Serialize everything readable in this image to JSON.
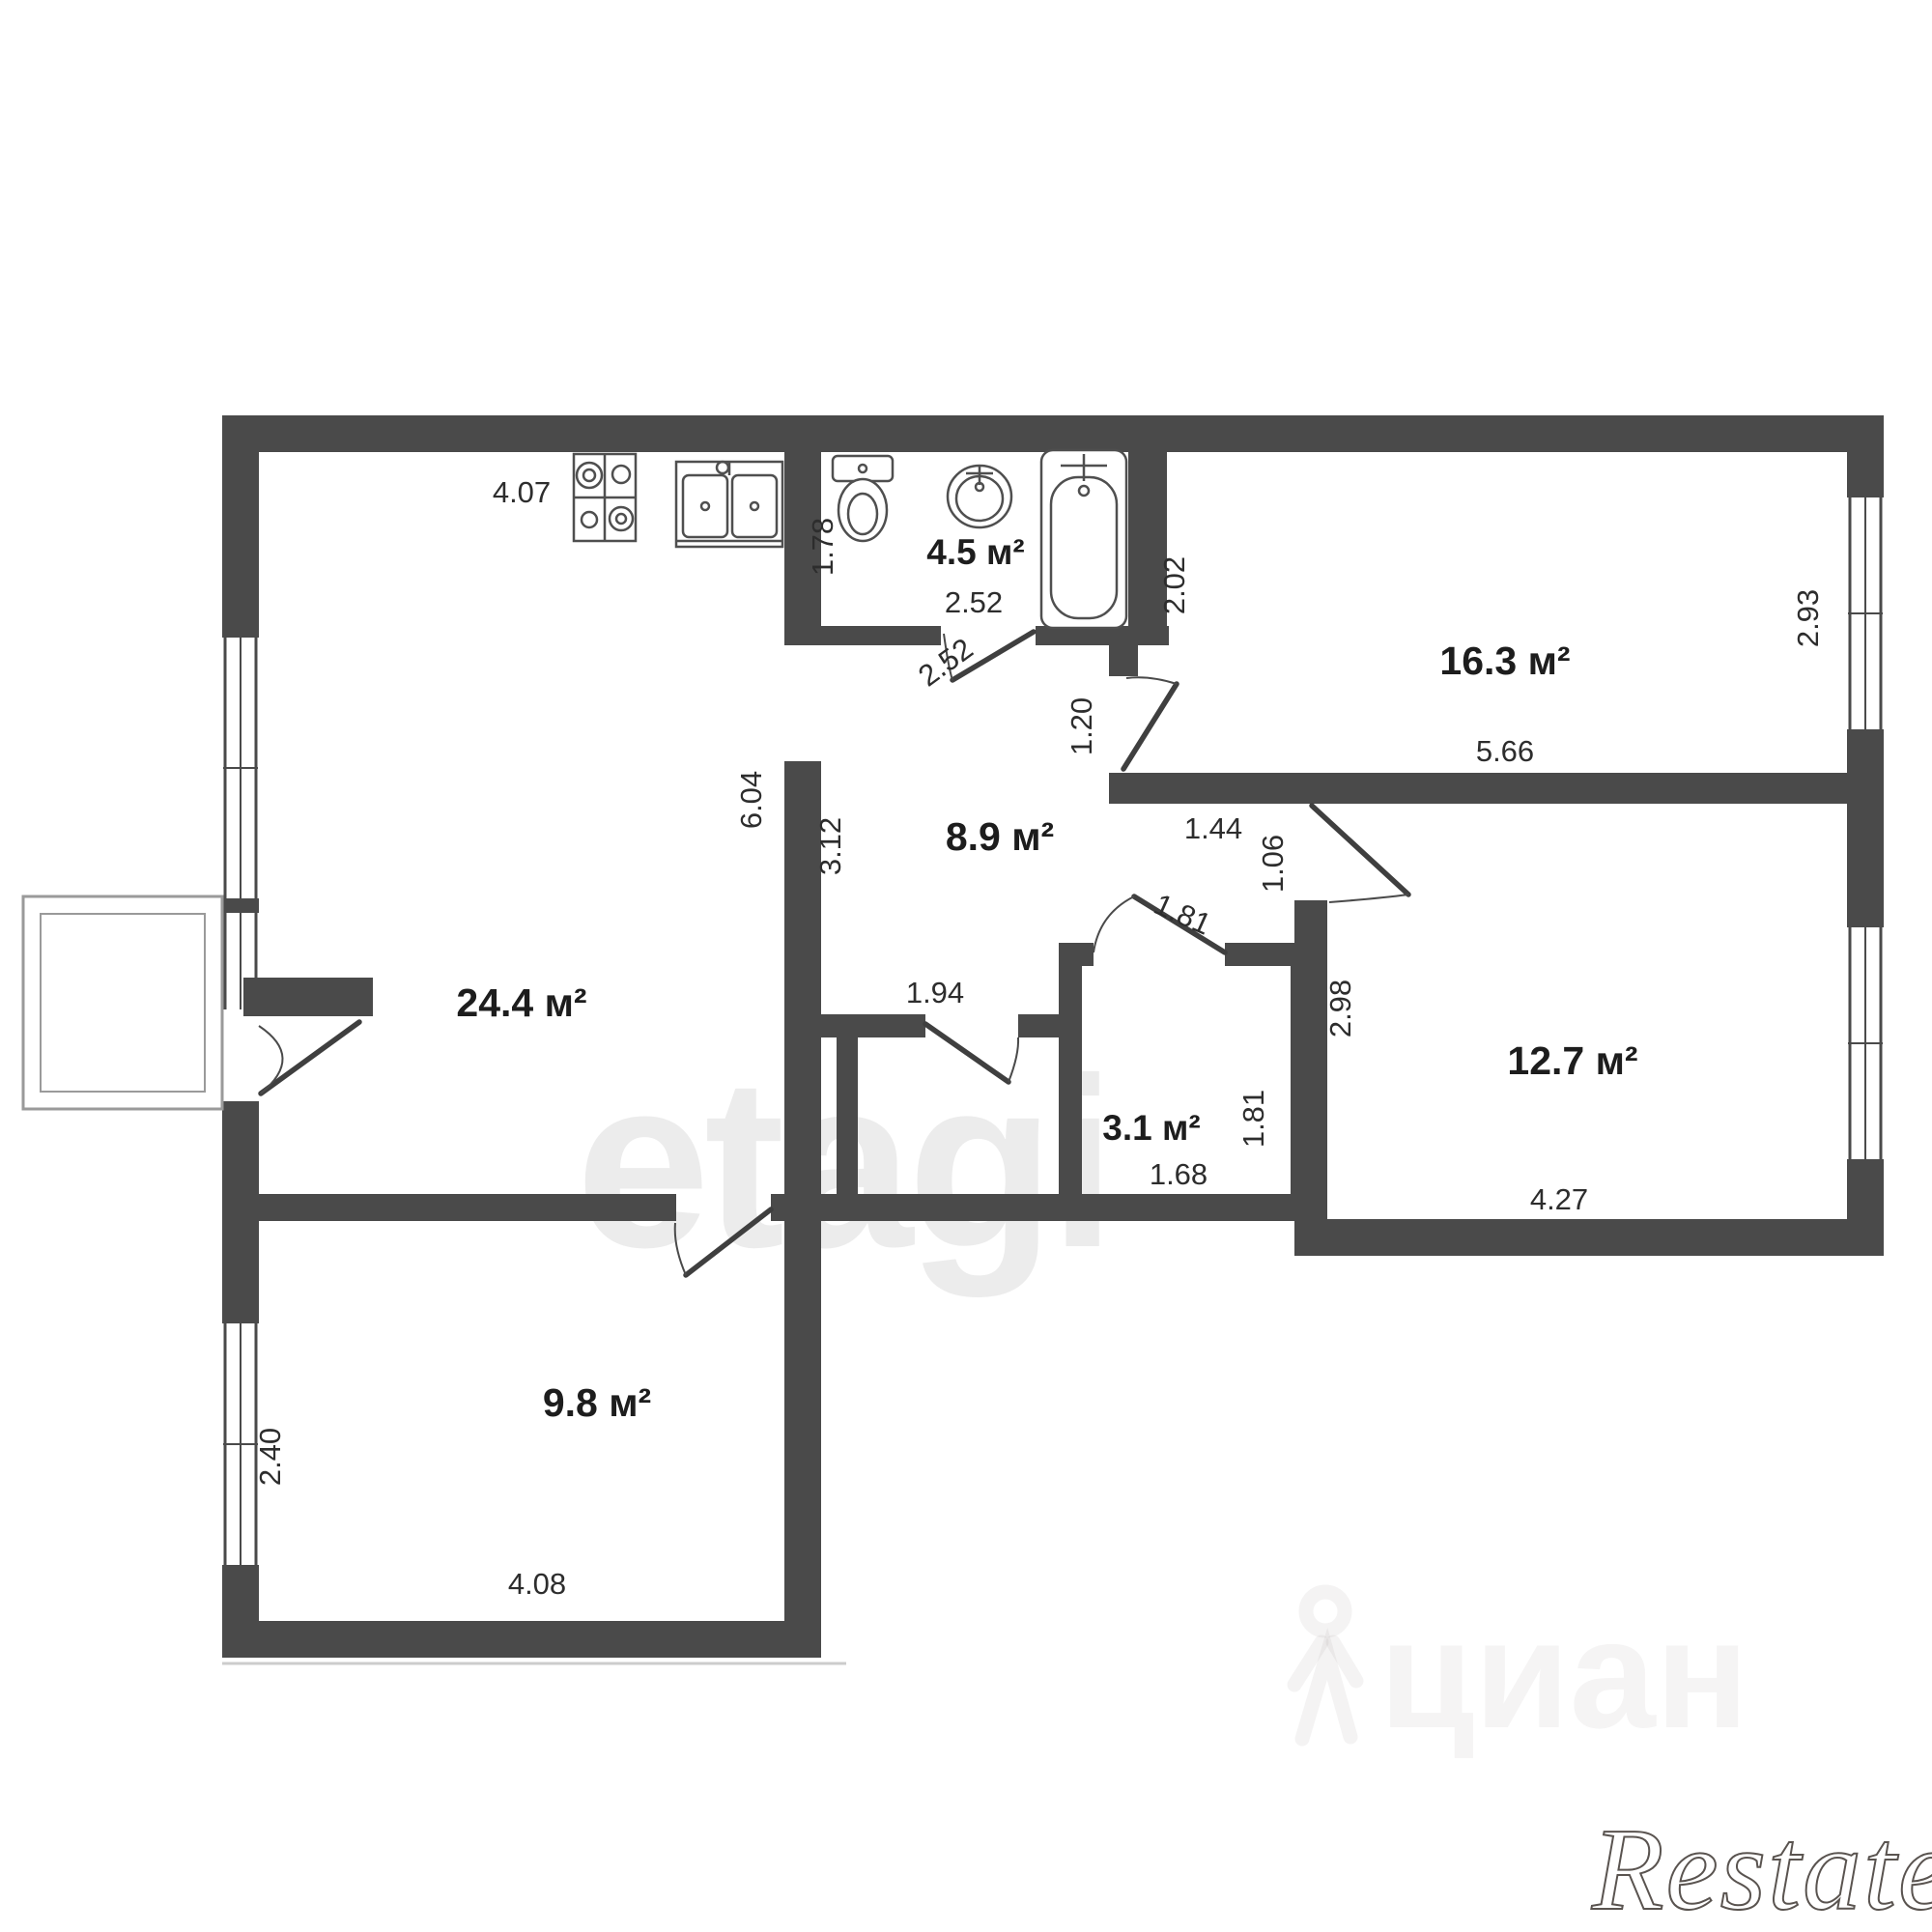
{
  "page": {
    "background": "#ffffff"
  },
  "plan": {
    "type": "apartment-floor-plan",
    "wall_color": "#4a4a4a",
    "rooms": [
      {
        "id": "living-kitchen",
        "label": "24.4 м²"
      },
      {
        "id": "bathroom",
        "label": "4.5 м²"
      },
      {
        "id": "bedroom-large",
        "label": "16.3 м²"
      },
      {
        "id": "hallway",
        "label": "8.9 м²"
      },
      {
        "id": "storage",
        "label": "3.1 м²"
      },
      {
        "id": "bedroom-medium",
        "label": "12.7 м²"
      },
      {
        "id": "bedroom-small",
        "label": "9.8 м²"
      }
    ],
    "dimensions": {
      "kitchen_top": "4.07",
      "bath_height": "1.78",
      "bath_width": "2.52",
      "bath_door": "2.52",
      "room16_left": "2.02",
      "room16_bottom": "5.66",
      "room16_window": "2.93",
      "door_room16": "1.20",
      "hall_ext_top": "1.44",
      "door_room12": "1.06",
      "living_right": "6.04",
      "hall_left": "3.12",
      "hall_bottom": "1.94",
      "door_storage": "1.81",
      "room12_left": "2.98",
      "storage_right": "1.81",
      "storage_bottom": "1.68",
      "room12_bottom": "4.27",
      "room9_left": "2.40",
      "room9_bottom": "4.08"
    },
    "fixtures": [
      "stove-icon",
      "kitchen-sink-icon",
      "toilet-icon",
      "washbasin-icon",
      "bathtub-icon"
    ]
  },
  "watermarks": {
    "center": "etagi",
    "portal": "циан",
    "corner": "Restate"
  }
}
